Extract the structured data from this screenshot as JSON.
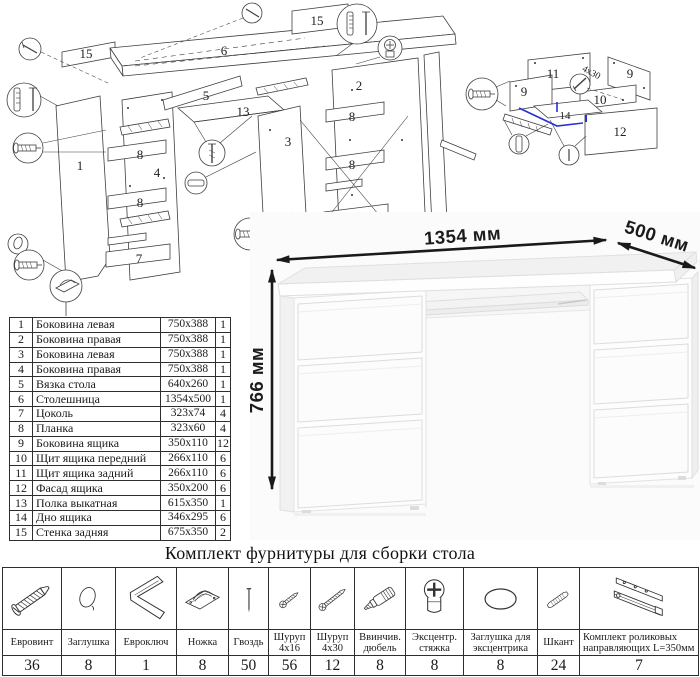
{
  "diagram": {
    "main_labels": {
      "p1": "1",
      "p2": "2",
      "p3": "3",
      "p4": "4",
      "p5": "5",
      "p6": "6",
      "p7": "7",
      "p8": "8",
      "p13": "13",
      "p15": "15"
    },
    "drawer_labels": {
      "p9": "9",
      "p10": "10",
      "p11": "11",
      "p12": "12",
      "p14": "14"
    },
    "screw_note": "4x30"
  },
  "photo": {
    "dim_width": "1354 мм",
    "dim_depth": "500 мм",
    "dim_height": "766 мм"
  },
  "parts_table": {
    "rows": [
      {
        "num": "1",
        "name": "Боковина левая",
        "size": "750x388",
        "qty": "1"
      },
      {
        "num": "2",
        "name": "Боковина правая",
        "size": "750x388",
        "qty": "1"
      },
      {
        "num": "3",
        "name": "Боковина левая",
        "size": "750x388",
        "qty": "1"
      },
      {
        "num": "4",
        "name": "Боковина правая",
        "size": "750x388",
        "qty": "1"
      },
      {
        "num": "5",
        "name": "Вязка стола",
        "size": "640x260",
        "qty": "1"
      },
      {
        "num": "6",
        "name": "Столешница",
        "size": "1354x500",
        "qty": "1"
      },
      {
        "num": "7",
        "name": "Цоколь",
        "size": "323x74",
        "qty": "4"
      },
      {
        "num": "8",
        "name": "Планка",
        "size": "323x60",
        "qty": "4"
      },
      {
        "num": "9",
        "name": "Боковина ящика",
        "size": "350x110",
        "qty": "12"
      },
      {
        "num": "10",
        "name": "Щит ящика передний",
        "size": "266x110",
        "qty": "6"
      },
      {
        "num": "11",
        "name": "Щит ящика задний",
        "size": "266x110",
        "qty": "6"
      },
      {
        "num": "12",
        "name": "Фасад ящика",
        "size": "350x200",
        "qty": "6"
      },
      {
        "num": "13",
        "name": "Полка выкатная",
        "size": "615x350",
        "qty": "1"
      },
      {
        "num": "14",
        "name": "Дно ящика",
        "size": "346x295",
        "qty": "6"
      },
      {
        "num": "15",
        "name": "Стенка задняя",
        "size": "675x350",
        "qty": "2"
      }
    ]
  },
  "hardware": {
    "title": "Комплект фурнитуры для сборки стола",
    "items": [
      {
        "icon": "euro-screw-icon",
        "name": "Евровинт",
        "qty": "36"
      },
      {
        "icon": "cap-plug-icon",
        "name": "Заглушка",
        "qty": "8"
      },
      {
        "icon": "hex-key-icon",
        "name": "Евроключ",
        "qty": "1"
      },
      {
        "icon": "foot-icon",
        "name": "Ножка",
        "qty": "8"
      },
      {
        "icon": "nail-icon",
        "name": "Гвоздь",
        "qty": "50"
      },
      {
        "icon": "screw-16-icon",
        "name": "Шуруп 4x16",
        "qty": "56"
      },
      {
        "icon": "screw-30-icon",
        "name": "Шуруп 4x30",
        "qty": "12"
      },
      {
        "icon": "screw-dowel-icon",
        "name": "Ввинчив. дюбель",
        "qty": "8"
      },
      {
        "icon": "cam-lock-icon",
        "name": "Эксцентр. стяжка",
        "qty": "8"
      },
      {
        "icon": "cam-cap-icon",
        "name": "Заглушка для эксцентрика",
        "qty": "8"
      },
      {
        "icon": "wood-dowel-icon",
        "name": "Шкант",
        "qty": "24"
      },
      {
        "icon": "drawer-slides-icon",
        "name": "Комплект роликовых направляющих L=350мм",
        "qty": "7"
      }
    ]
  },
  "colors": {
    "line": "#3f3f3f",
    "blue": "#2433d0",
    "dim": "#1a1a1a",
    "photo_bg": "#fbfbfb"
  }
}
